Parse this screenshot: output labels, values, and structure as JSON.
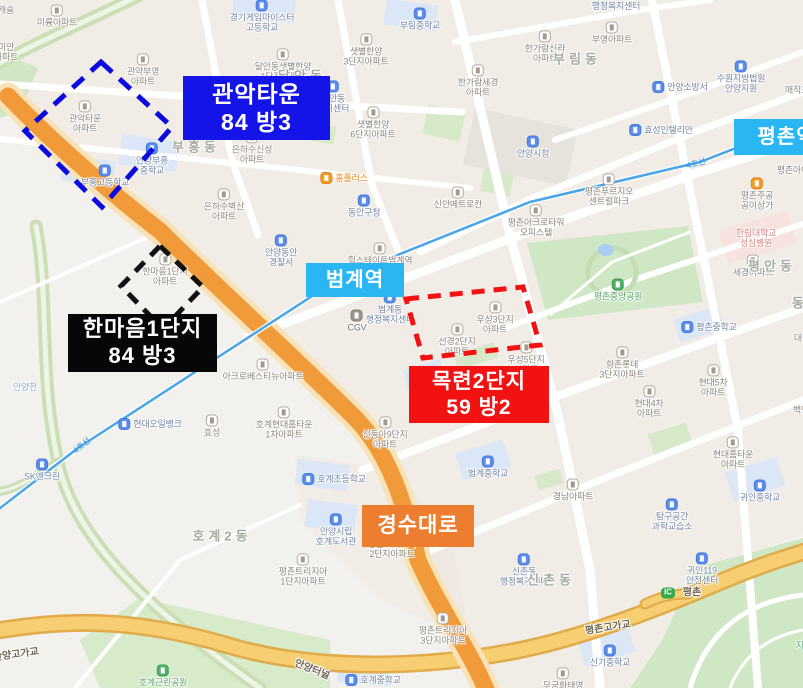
{
  "annotations": {
    "gwanak": {
      "name": "관악타운",
      "spec": "84 방3",
      "box_color": "#0b0bdf"
    },
    "hanmaeum": {
      "name": "한마음1단지",
      "spec": "84 방3",
      "box_color": "#111111"
    },
    "mokryeon": {
      "name": "목련2단지",
      "spec": "59 방2",
      "box_color": "#f31111"
    },
    "road_badge": "경수대로",
    "station_beomgye": "범계역",
    "station_pyeongchon": "평촌역"
  },
  "colors": {
    "annotation_blue": "#1414e8",
    "annotation_black": "#070707",
    "annotation_red": "#f21212",
    "road_badge_orange": "#ed7d2f",
    "station_badge_blue": "#29b6f2",
    "main_road_orange": "#f19a3a",
    "highway_yellow": "#f7cf72",
    "subway_line4_blue": "#49a6e6",
    "park_green": "#cfe7c4"
  },
  "map_labels": [
    {
      "t": "캐슬",
      "x": 6,
      "y": 10,
      "c": "apt"
    },
    {
      "t": "미륭아파트",
      "x": 57,
      "y": 16,
      "c": "apt",
      "p": 1
    },
    {
      "t": "미안|아파트",
      "x": 6,
      "y": 52,
      "c": "apt"
    },
    {
      "t": "경기게임마이스터|고등학교",
      "x": 262,
      "y": 16,
      "c": "school",
      "p": 1
    },
    {
      "t": "부림중학교",
      "x": 420,
      "y": 19,
      "c": "school",
      "p": 1
    },
    {
      "t": "행정복지센터",
      "x": 616,
      "y": 6,
      "c": "public"
    },
    {
      "t": "부영아파트",
      "x": 612,
      "y": 33,
      "c": "apt",
      "p": 1
    },
    {
      "t": "한가람신라|아파트",
      "x": 545,
      "y": 47,
      "c": "apt",
      "p": 1
    },
    {
      "t": "부림동",
      "x": 577,
      "y": 60,
      "c": "district"
    },
    {
      "t": "한가람세경|아파트",
      "x": 478,
      "y": 81,
      "c": "apt",
      "p": 1
    },
    {
      "t": "달안동샛별한양|1단지아파트",
      "x": 283,
      "y": 65,
      "c": "apt",
      "p": 1
    },
    {
      "t": "샛별한양|3단지아파트",
      "x": 366,
      "y": 50,
      "c": "apt",
      "p": 1
    },
    {
      "t": "샛별한양|6단지아파트",
      "x": 373,
      "y": 123,
      "c": "apt",
      "p": 1
    },
    {
      "t": "수원지방법원|안양지원",
      "x": 741,
      "y": 77,
      "c": "public",
      "p": 1
    },
    {
      "t": "매직포",
      "x": 797,
      "y": 90,
      "c": "apt"
    },
    {
      "t": "안양소방서",
      "x": 680,
      "y": 87,
      "c": "public",
      "p": 1,
      "s": "l"
    },
    {
      "t": "관악부영|아파트",
      "x": 143,
      "y": 70,
      "c": "apt",
      "p": 1
    },
    {
      "t": "관악타운|아파트",
      "x": 85,
      "y": 117,
      "c": "apt",
      "p": 1
    },
    {
      "t": "달안동",
      "x": 302,
      "y": 77,
      "c": "district"
    },
    {
      "t": "달안동|복지센터",
      "x": 333,
      "y": 97,
      "c": "public",
      "p": 1
    },
    {
      "t": "부흥동",
      "x": 196,
      "y": 148,
      "c": "district"
    },
    {
      "t": "안양부흥|중학교",
      "x": 152,
      "y": 159,
      "c": "school",
      "p": 1
    },
    {
      "t": "부흥고등학교",
      "x": 105,
      "y": 176,
      "c": "school",
      "p": 1
    },
    {
      "t": "은하수신성|아파트",
      "x": 252,
      "y": 148,
      "c": "apt",
      "p": 1
    },
    {
      "t": "은하수벽산|아파트",
      "x": 224,
      "y": 205,
      "c": "apt",
      "p": 1
    },
    {
      "t": "홈플러스",
      "x": 344,
      "y": 178,
      "c": "storeo",
      "p": 1,
      "s": "l"
    },
    {
      "t": "동안구청",
      "x": 364,
      "y": 206,
      "c": "public",
      "p": 1
    },
    {
      "t": "안양시청",
      "x": 533,
      "y": 147,
      "c": "public",
      "p": 1
    },
    {
      "t": "효성인텔리안",
      "x": 661,
      "y": 130,
      "c": "public",
      "p": 1,
      "s": "l"
    },
    {
      "t": "평촌아이파크",
      "x": 801,
      "y": 170,
      "c": "apt"
    },
    {
      "t": "평촌주공|공이상가",
      "x": 757,
      "y": 194,
      "c": "store",
      "p": 1
    },
    {
      "t": "평촌푸르지오|센트럴파크",
      "x": 609,
      "y": 190,
      "c": "apt",
      "p": 1
    },
    {
      "t": "신안메트로칸",
      "x": 458,
      "y": 198,
      "c": "apt",
      "p": 1
    },
    {
      "t": "평촌아크로타워|오피스텔",
      "x": 536,
      "y": 221,
      "c": "apt",
      "p": 1
    },
    {
      "t": "한림대학교|성심병원",
      "x": 756,
      "y": 238,
      "c": "hospital"
    },
    {
      "t": "세경아파트",
      "x": 753,
      "y": 266,
      "c": "apt",
      "p": 1
    },
    {
      "t": "평안동",
      "x": 772,
      "y": 267,
      "c": "district"
    },
    {
      "t": "동안",
      "x": 808,
      "y": 304,
      "c": "district"
    },
    {
      "t": "평촌중앙공원",
      "x": 618,
      "y": 290,
      "c": "park",
      "p": 1
    },
    {
      "t": "안양동안|경찰서",
      "x": 281,
      "y": 251,
      "c": "public",
      "p": 1
    },
    {
      "t": "한마음1단지|아파트",
      "x": 165,
      "y": 270,
      "c": "apt",
      "p": 1
    },
    {
      "t": "힐스테이트범계역|오피스텔",
      "x": 380,
      "y": 259,
      "c": "apt",
      "p": 1
    },
    {
      "t": "범계동|행정복지센터",
      "x": 390,
      "y": 308,
      "c": "public",
      "p": 1
    },
    {
      "t": "CGV",
      "x": 357,
      "y": 321,
      "c": "gray",
      "p": 1
    },
    {
      "t": "선경2단지|아파트",
      "x": 457,
      "y": 340,
      "c": "apt",
      "p": 1
    },
    {
      "t": "우성3단지|아파트",
      "x": 495,
      "y": 318,
      "c": "apt",
      "p": 1
    },
    {
      "t": "우성5단지|아파트",
      "x": 526,
      "y": 358,
      "c": "apt",
      "p": 1
    },
    {
      "t": "",
      "x": 421,
      "y": 379,
      "c": "school",
      "p": 1
    },
    {
      "t": "호계1동",
      "x": 447,
      "y": 381,
      "c": "district"
    },
    {
      "t": "평촌중학교",
      "x": 709,
      "y": 327,
      "c": "school",
      "p": 1,
      "s": "l"
    },
    {
      "t": "대림아",
      "x": 806,
      "y": 338,
      "c": "apt"
    },
    {
      "t": "향촌롯데|3단지아파트",
      "x": 622,
      "y": 363,
      "c": "apt",
      "p": 1
    },
    {
      "t": "현대5차|아파트",
      "x": 713,
      "y": 381,
      "c": "apt",
      "p": 1
    },
    {
      "t": "현대4차|아파트",
      "x": 649,
      "y": 402,
      "c": "apt",
      "p": 1
    },
    {
      "t": "백영",
      "x": 801,
      "y": 410,
      "c": "apt"
    },
    {
      "t": "현대홈타운|아파트",
      "x": 733,
      "y": 453,
      "c": "apt",
      "p": 1
    },
    {
      "t": "아크로베스티뉴아파트",
      "x": 263,
      "y": 370,
      "c": "apt",
      "p": 1
    },
    {
      "t": "안양천",
      "x": 25,
      "y": 387,
      "c": "river"
    },
    {
      "t": "현대오일뱅크",
      "x": 150,
      "y": 424,
      "c": "public",
      "p": 1,
      "s": "l"
    },
    {
      "t": "효성",
      "x": 212,
      "y": 426,
      "c": "apt",
      "p": 1
    },
    {
      "t": "호계현대홈타운|1차아파트",
      "x": 284,
      "y": 423,
      "c": "apt",
      "p": 1
    },
    {
      "t": "신동아9단지|아파트",
      "x": 385,
      "y": 433,
      "c": "apt",
      "p": 1
    },
    {
      "t": "SK엔크린",
      "x": 42,
      "y": 470,
      "c": "public",
      "p": 1
    },
    {
      "t": "호계초등학교",
      "x": 334,
      "y": 479,
      "c": "school",
      "p": 1,
      "s": "l"
    },
    {
      "t": "범계중학교",
      "x": 488,
      "y": 467,
      "c": "school",
      "p": 1
    },
    {
      "t": "경남아파트",
      "x": 573,
      "y": 490,
      "c": "apt",
      "p": 1
    },
    {
      "t": "탐구공간|과학교습소",
      "x": 672,
      "y": 515,
      "c": "public",
      "p": 1
    },
    {
      "t": "귀인중학교",
      "x": 760,
      "y": 491,
      "c": "school",
      "p": 1
    },
    {
      "t": "안양시립|호계도서관",
      "x": 336,
      "y": 530,
      "c": "public",
      "p": 1
    },
    {
      "t": "호계2동",
      "x": 222,
      "y": 537,
      "c": "district"
    },
    {
      "t": "신촌동|행정복지센터",
      "x": 524,
      "y": 570,
      "c": "public",
      "p": 1
    },
    {
      "t": "신촌동",
      "x": 551,
      "y": 581,
      "c": "district"
    },
    {
      "t": "평촌트리지아|1단지아파트",
      "x": 303,
      "y": 570,
      "c": "apt",
      "p": 1
    },
    {
      "t": "평촌트리지아|2단지아파트",
      "x": 392,
      "y": 549,
      "c": "apt"
    },
    {
      "t": "귀인119|안전센터",
      "x": 702,
      "y": 569,
      "c": "public",
      "p": 1
    },
    {
      "t": "IC",
      "x": 668,
      "y": 593,
      "c": "icchip"
    },
    {
      "t": "평촌",
      "x": 692,
      "y": 593,
      "c": "roadname"
    },
    {
      "t": "평촌고가교",
      "x": 608,
      "y": 628,
      "c": "roadname",
      "r": -9
    },
    {
      "t": "신기중학교",
      "x": 610,
      "y": 656,
      "c": "school",
      "p": 1
    },
    {
      "t": "평촌트리지아|3단지아파트",
      "x": 443,
      "y": 629,
      "c": "apt",
      "p": 1
    },
    {
      "t": "무궁화태영|아파트",
      "x": 563,
      "y": 684,
      "c": "apt",
      "p": 1
    },
    {
      "t": "자유공원",
      "x": 812,
      "y": 639,
      "c": "park",
      "p": 1
    },
    {
      "t": "안양고가교",
      "x": 16,
      "y": 655,
      "c": "roadname",
      "r": -8
    },
    {
      "t": "호계근린공원",
      "x": 163,
      "y": 676,
      "c": "park",
      "p": 1
    },
    {
      "t": "안양터널",
      "x": 312,
      "y": 670,
      "c": "roadname",
      "r": 22
    },
    {
      "t": "호계중학교",
      "x": 373,
      "y": 680,
      "c": "school",
      "p": 1,
      "s": "l"
    },
    {
      "t": "4호선",
      "x": 82,
      "y": 446,
      "c": "subway",
      "r": -39
    },
    {
      "t": "4호선",
      "x": 696,
      "y": 164,
      "c": "subway",
      "r": -14
    }
  ]
}
